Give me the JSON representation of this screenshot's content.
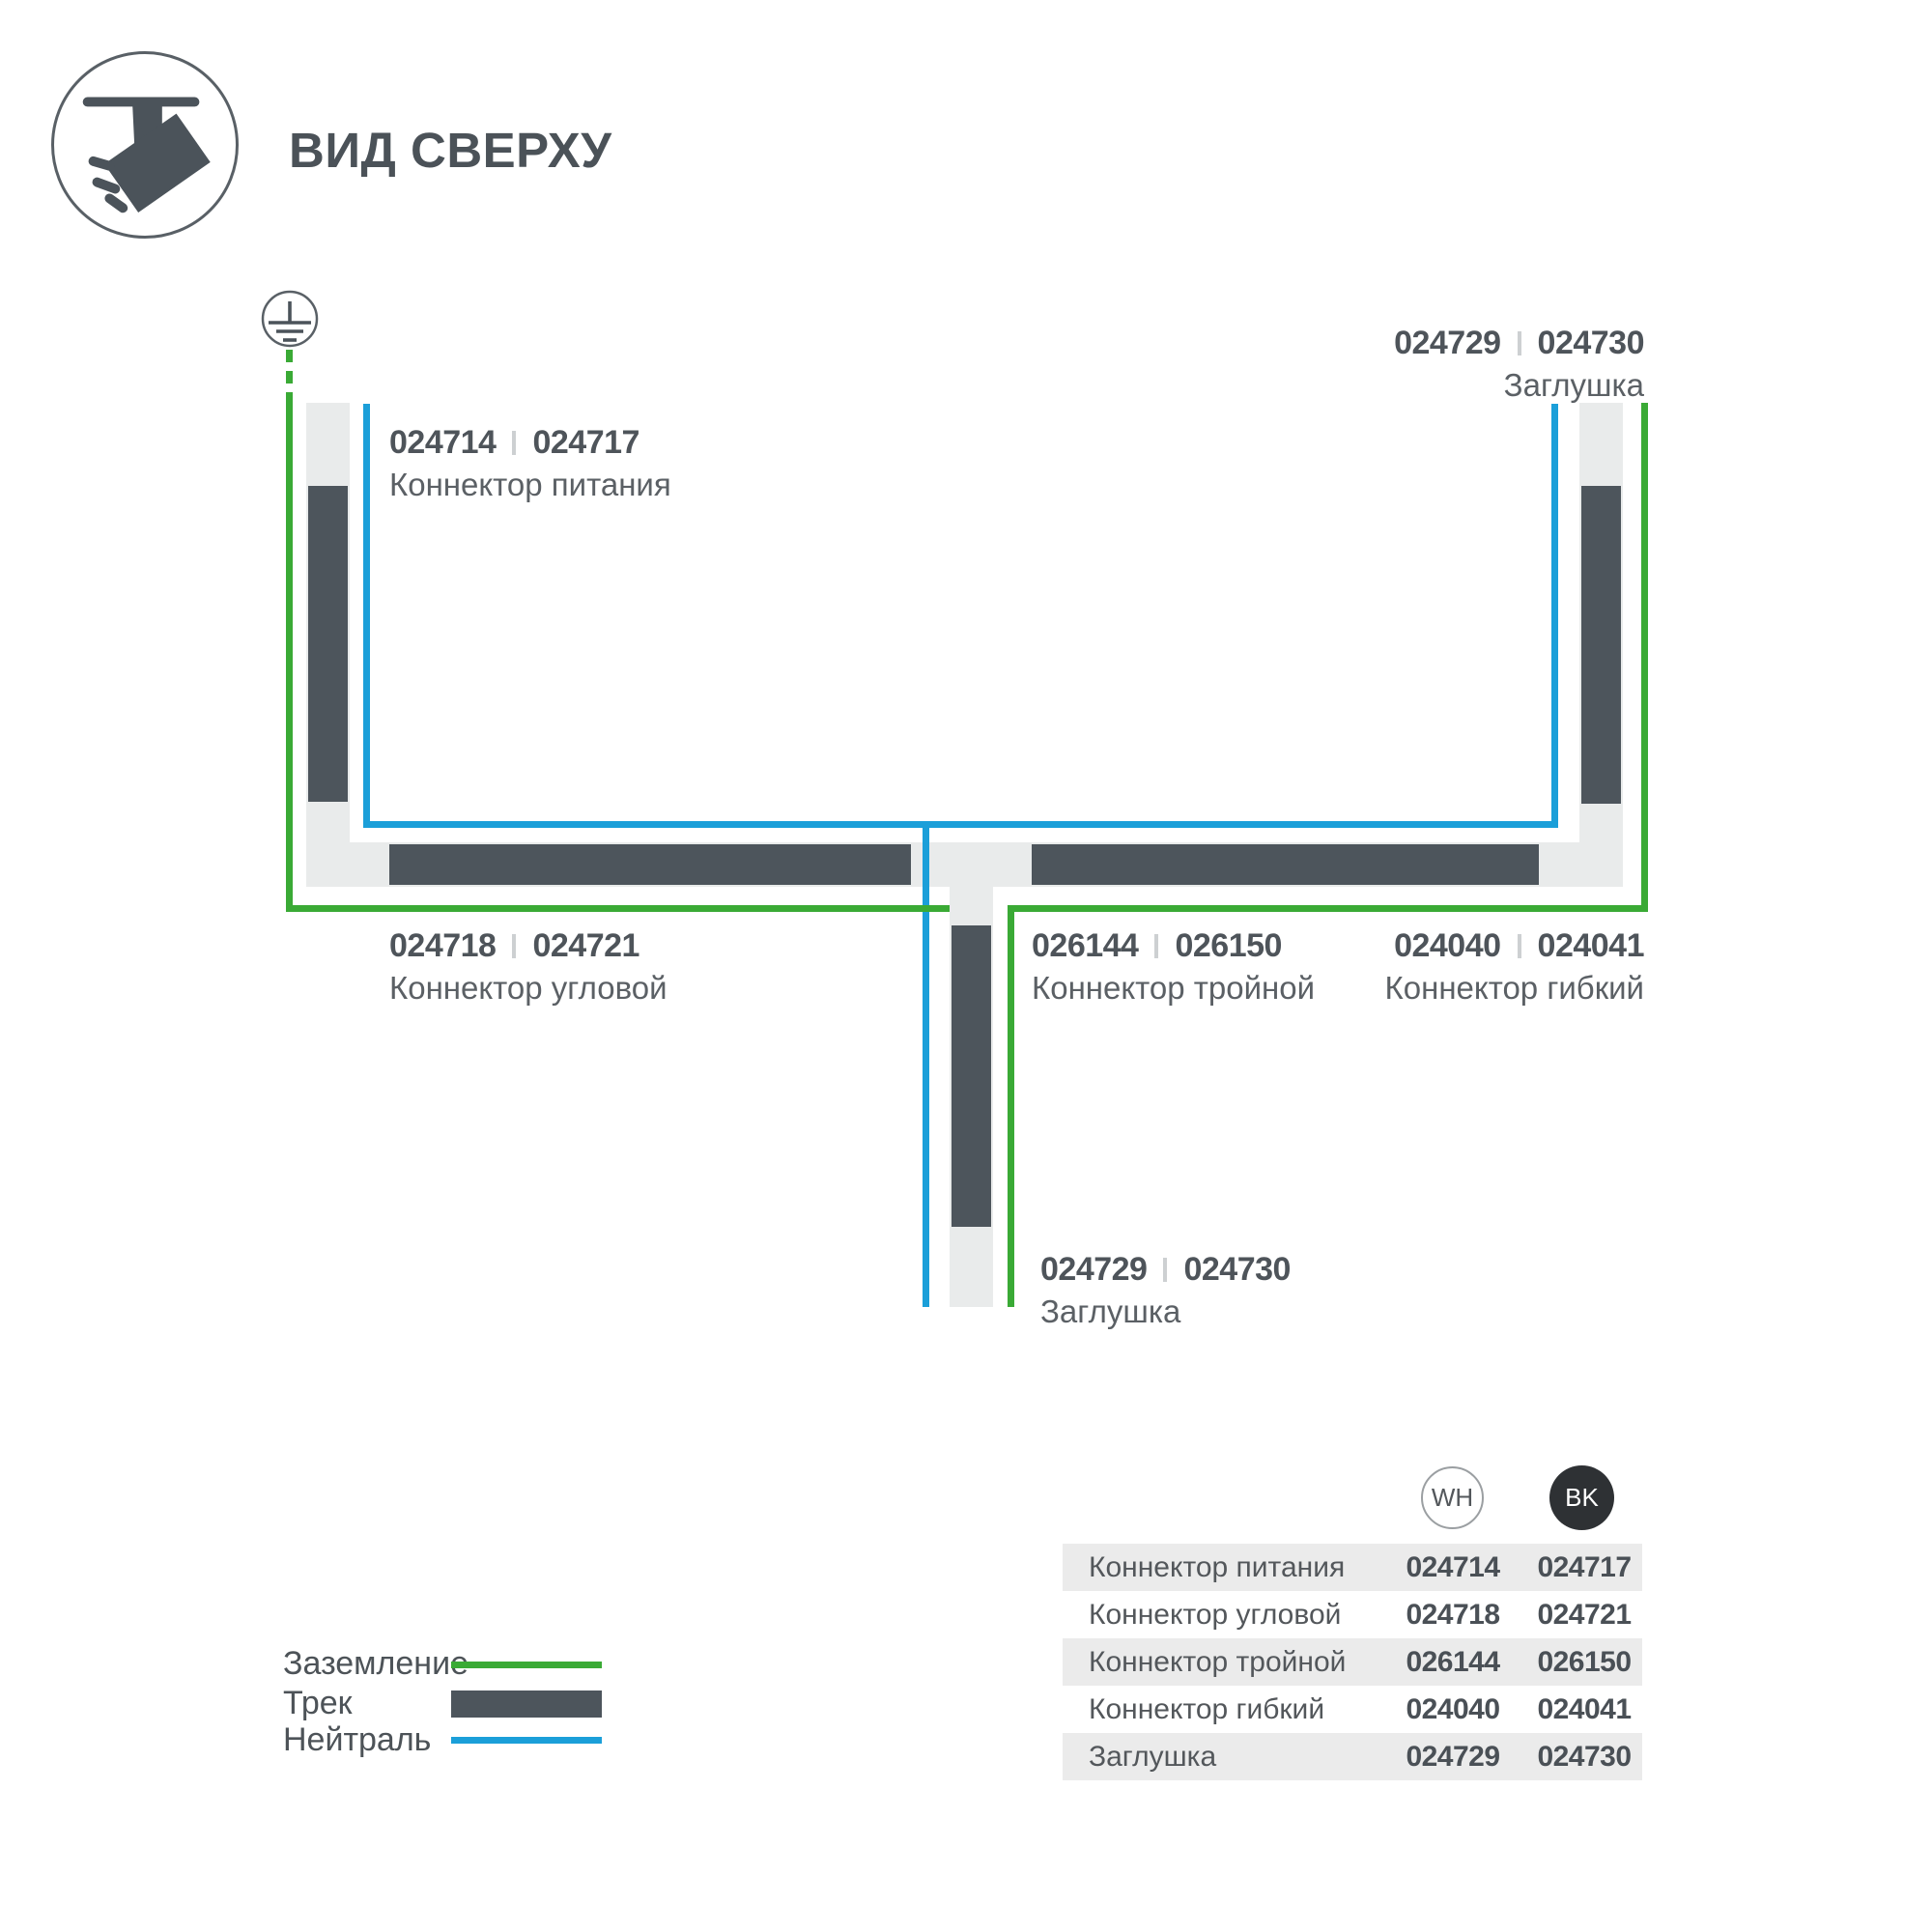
{
  "header": {
    "title": "ВИД СВЕРХУ"
  },
  "diagram": {
    "labels": [
      {
        "code_left": "024714",
        "code_right": "024717",
        "name": "Коннектор питания"
      },
      {
        "code_left": "024729",
        "code_right": "024730",
        "name": "Заглушка"
      },
      {
        "code_left": "024718",
        "code_right": "024721",
        "name": "Коннектор угловой"
      },
      {
        "code_left": "026144",
        "code_right": "026150",
        "name": "Коннектор тройной"
      },
      {
        "code_left": "024040",
        "code_right": "024041",
        "name": "Коннектор гибкий"
      },
      {
        "code_left": "024729",
        "code_right": "024730",
        "name": "Заглушка"
      }
    ]
  },
  "legend": {
    "items": [
      {
        "label": "Заземление",
        "type": "ground-line"
      },
      {
        "label": "Трек",
        "type": "track-bar"
      },
      {
        "label": "Нейтраль",
        "type": "neutral-line"
      }
    ]
  },
  "table": {
    "columns": [
      {
        "label": "WH"
      },
      {
        "label": "BK"
      }
    ],
    "rows": [
      {
        "name": "Коннектор питания",
        "wh": "024714",
        "bk": "024717"
      },
      {
        "name": "Коннектор угловой",
        "wh": "024718",
        "bk": "024721"
      },
      {
        "name": "Коннектор тройной",
        "wh": "026144",
        "bk": "026150"
      },
      {
        "name": "Коннектор гибкий",
        "wh": "024040",
        "bk": "024041"
      },
      {
        "name": "Заглушка",
        "wh": "024729",
        "bk": "024730"
      }
    ]
  },
  "icons": {
    "top_view": "spotlight-track-icon",
    "ground": "earth-ground-icon"
  },
  "colors": {
    "ground_green": "#3aaa35",
    "neutral_blue": "#1b9fd9",
    "track_dark": "#4d555c",
    "track_light": "#e9ebeb",
    "table_row_gray": "#ebebeb",
    "bk_circle": "#2e3134"
  }
}
